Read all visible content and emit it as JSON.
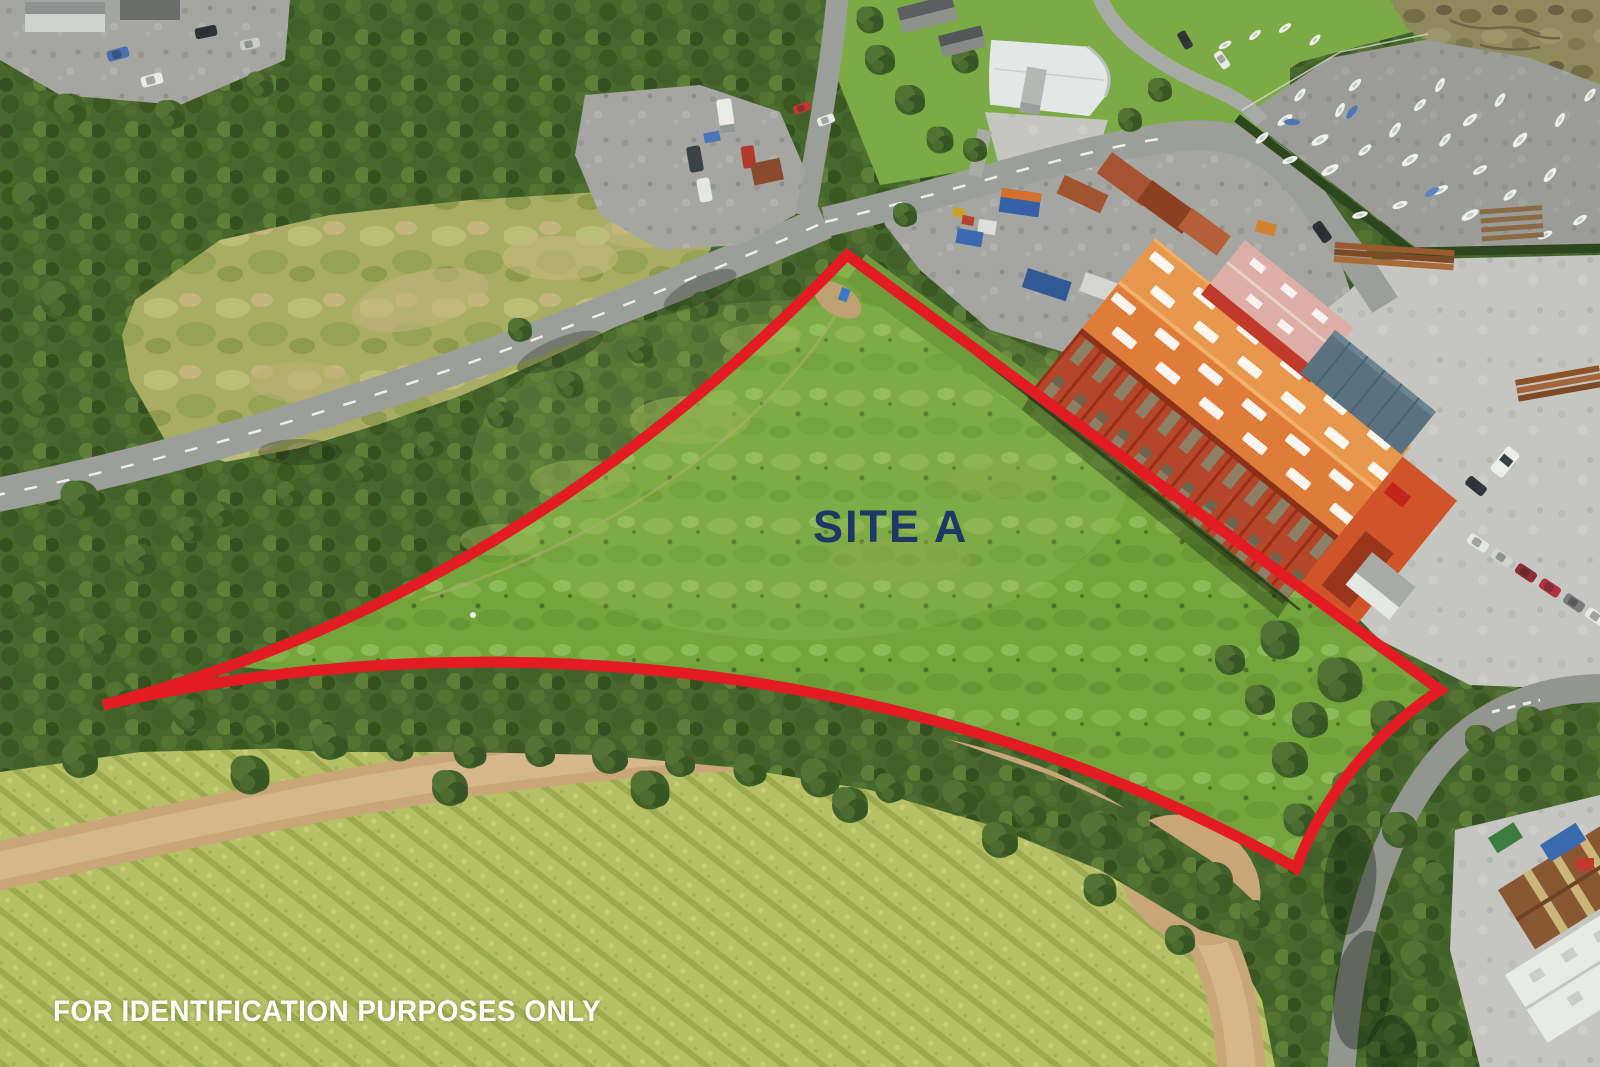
{
  "annotations": {
    "site_label": "SITE A",
    "disclaimer": "FOR IDENTIFICATION PURPOSES ONLY"
  },
  "colors": {
    "boundary_red": "#e31b23",
    "site_label_navy": "#1d3766",
    "disclaimer_white": "#ffffff"
  }
}
